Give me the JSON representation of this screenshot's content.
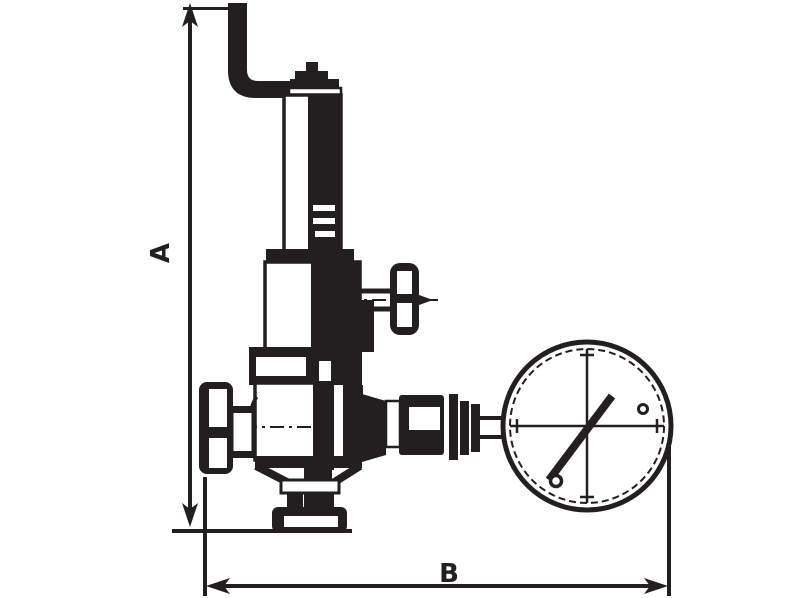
{
  "colors": {
    "line": "#231f20",
    "background": "#ffffff"
  },
  "labels": {
    "dim_height": "A",
    "dim_width": "B"
  },
  "drawing": {
    "type": "technical-line-drawing",
    "subject": "pressure reducing valve with pressure gauge",
    "dimension_callouts": [
      {
        "label": "A",
        "orientation": "vertical"
      },
      {
        "label": "B",
        "orientation": "horizontal"
      }
    ],
    "parts": [
      "inlet-pipe-elbow",
      "top-adjustment-cap",
      "spring-bonnet-tube",
      "bonnet-flange",
      "spring-housing",
      "valve-body",
      "inlet-handwheel",
      "side-shutoff-valve",
      "side-handwheel",
      "outlet-union-train",
      "pressure-gauge",
      "gauge-needle",
      "drain-funnel",
      "drain-cap"
    ]
  }
}
